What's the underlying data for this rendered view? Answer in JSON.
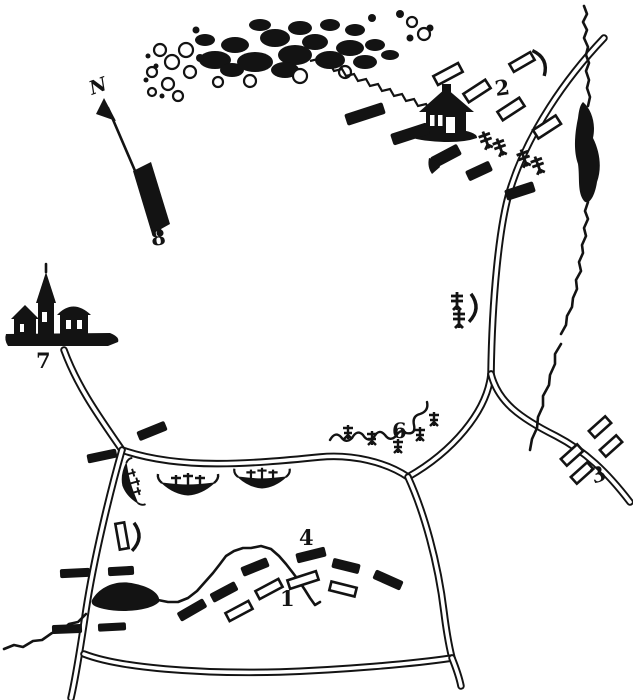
{
  "title": "Hand-drawn battle sketch map",
  "colors": {
    "ink": "#131313",
    "paper": "#ffffff"
  },
  "labels": {
    "north": "N",
    "n1": "1",
    "n2": "2",
    "n3": "3",
    "n4": "4",
    "n6": "6",
    "n7": "7",
    "n8": "8"
  },
  "symbols": {
    "woods": "woods-scribble",
    "north_arrow": "north-arrow",
    "house": "house-icon",
    "village": "village-church-icon",
    "solid_bar": "troop-bar-solid",
    "outline_bar": "troop-bar-outline",
    "battery": "battery-cross-icon",
    "boat": "boat-icon",
    "hedgerow": "hedgerow-trees",
    "bracket": "bracket-marker",
    "flag": "flag-marker",
    "pond": "pond",
    "stream": "stream",
    "road": "double-line-road"
  },
  "counts": {
    "solid_bars": 17,
    "outline_bars": 14,
    "battery_crosses": 6,
    "boats": 3
  }
}
